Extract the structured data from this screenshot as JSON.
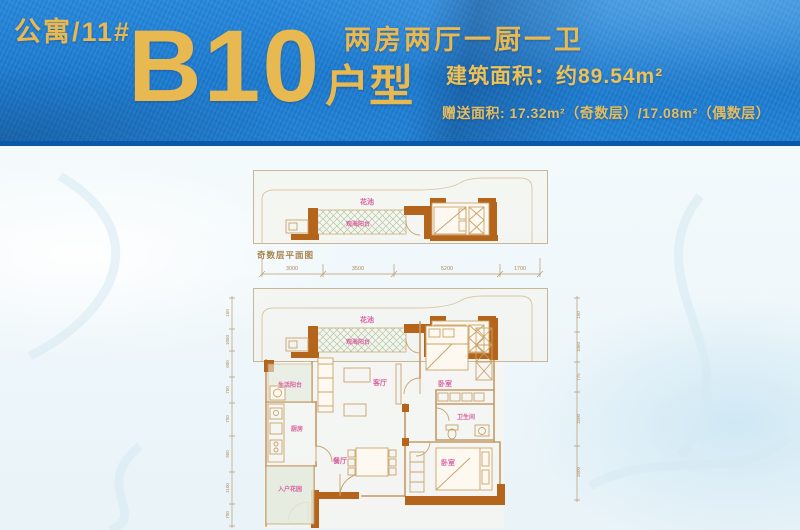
{
  "header": {
    "building": "公寓/11#",
    "unit_number": "B10",
    "unit_type_suffix": "户型",
    "layout": "两房两厅一厨一卫",
    "area": "建筑面积：约89.54m²",
    "bonus_area": "赠送面积: 17.32m²（奇数层）/17.08m²（偶数层）"
  },
  "colors": {
    "band_blue": "#1f80d4",
    "band_border": "#0a58a9",
    "gold": "#e8b851",
    "wall_orange": "#b5641c",
    "plan_line": "#c49a66",
    "label_pink": "#d8619e",
    "caption_brown": "#a8844e"
  },
  "odd_plan": {
    "caption": "奇数层平面图",
    "flower_bed": "花池",
    "sea_balcony": "观海阳台",
    "dims": [
      "3000",
      "3500",
      "5200",
      "1700"
    ]
  },
  "main_plan": {
    "flower_bed": "花池",
    "sea_balcony": "观海阳台",
    "living_room": "客厅",
    "bedroom_top": "卧室",
    "bedroom_bottom": "卧室",
    "life_balcony": "生活阳台",
    "kitchen": "厨房",
    "bathroom": "卫生间",
    "dining_room": "餐厅",
    "entry_garden": "入户花园",
    "left_dims": [
      "150",
      "1050",
      "600",
      "750",
      "750",
      "950",
      "1100",
      "700"
    ],
    "right_dims": [
      "150",
      "1060",
      "775",
      "1500",
      "2600"
    ]
  }
}
